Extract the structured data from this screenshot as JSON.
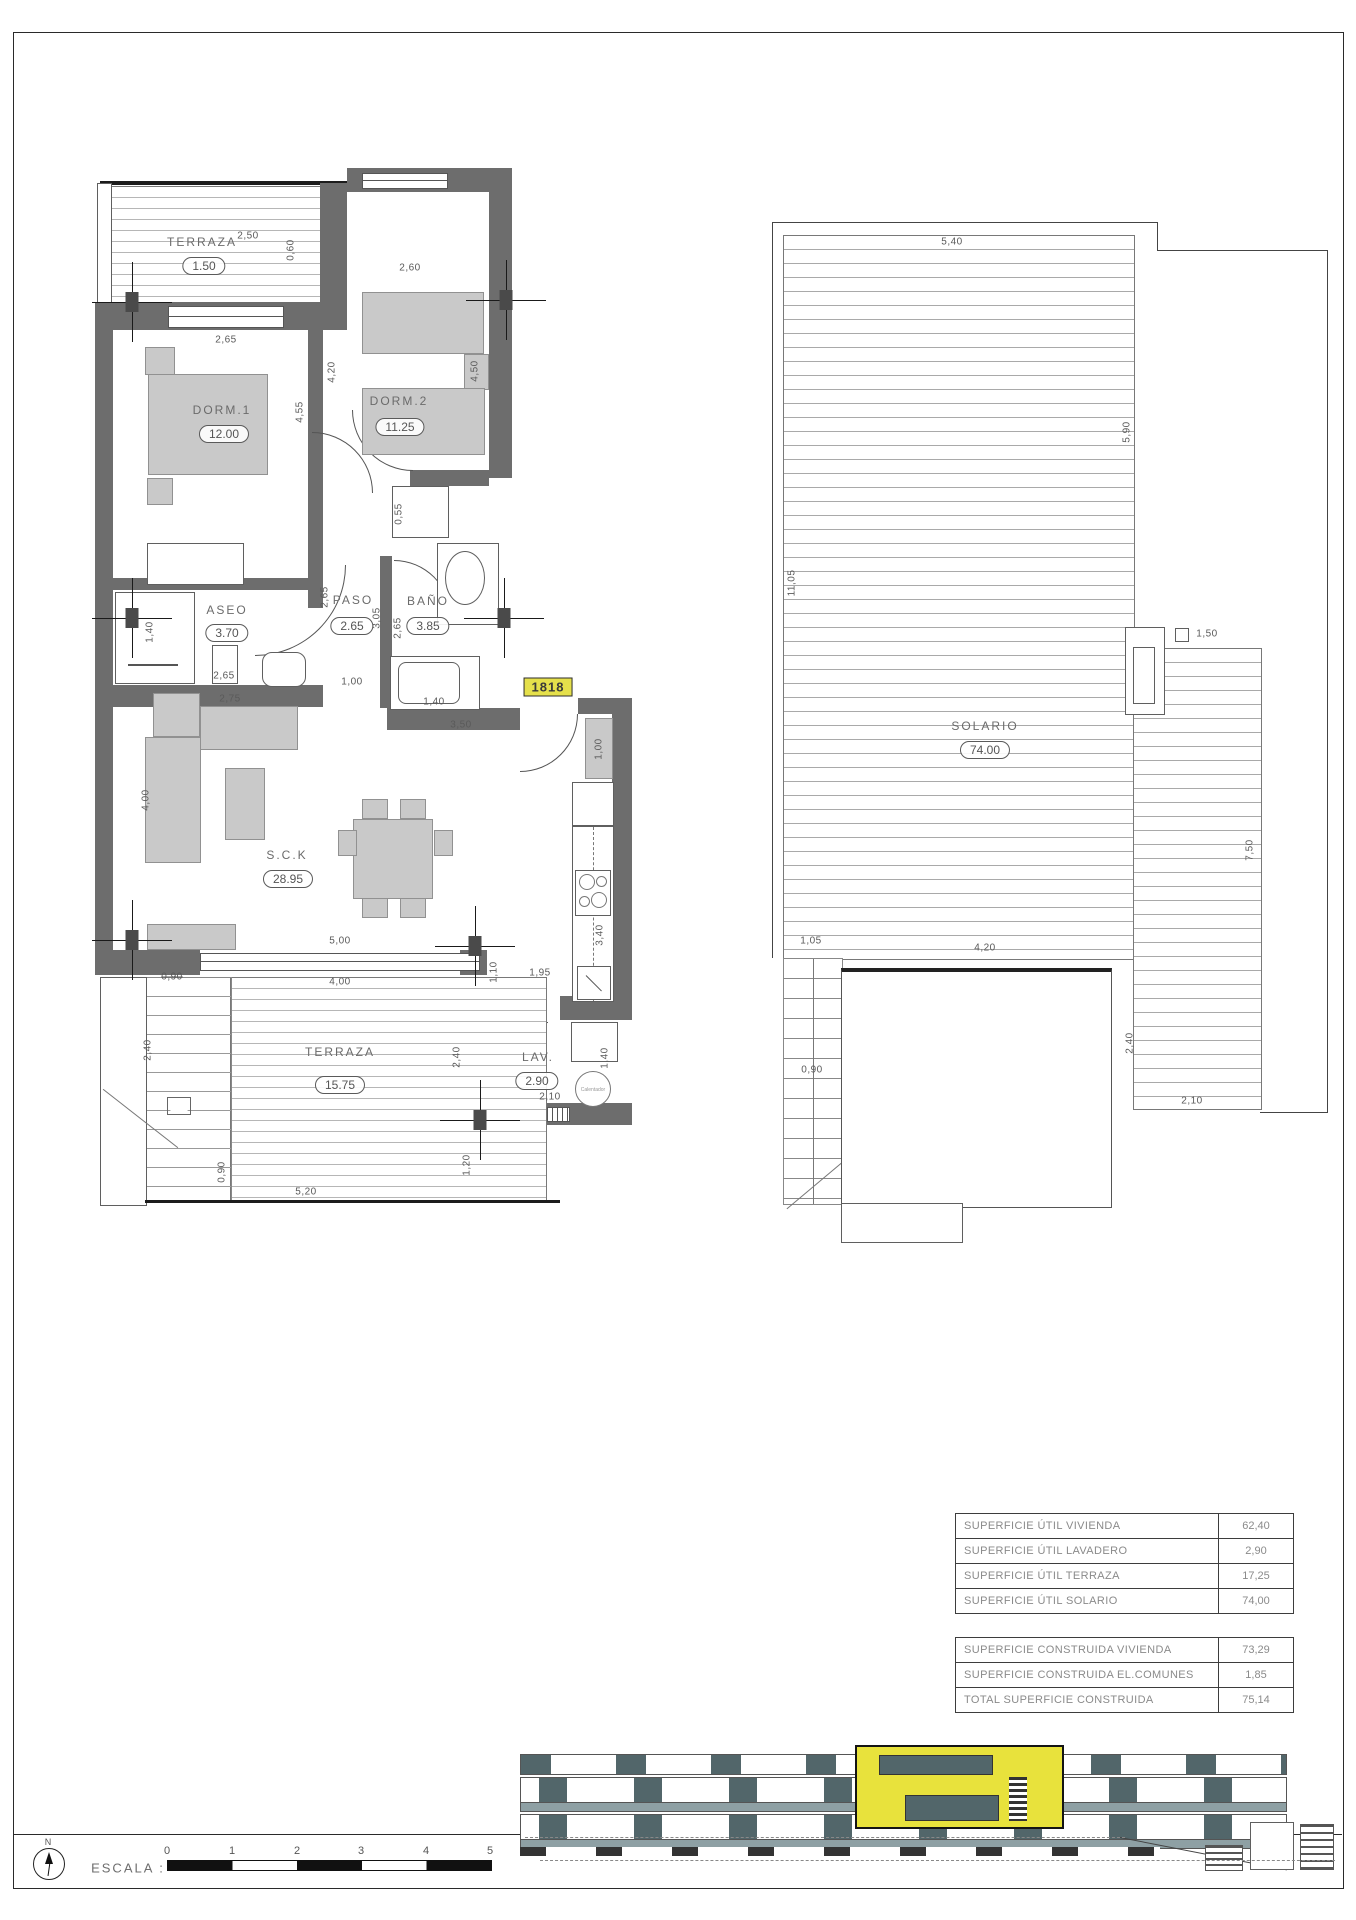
{
  "sheet": {
    "unit_badge": "1818",
    "compass_label": "N",
    "scale": {
      "label": "ESCALA :",
      "ticks": [
        "0",
        "1",
        "2",
        "3",
        "4",
        "5"
      ]
    }
  },
  "floor_plan": {
    "rooms": [
      {
        "name": "TERRAZA",
        "area": "1.50"
      },
      {
        "name": "DORM.1",
        "area": "12.00"
      },
      {
        "name": "DORM.2",
        "area": "11.25"
      },
      {
        "name": "ASEO",
        "area": "3.70"
      },
      {
        "name": "PASO",
        "area": "2.65"
      },
      {
        "name": "BAÑO",
        "area": "3.85"
      },
      {
        "name": "S.C.K",
        "area": "28.95"
      },
      {
        "name": "TERRAZA",
        "area": "15.75"
      },
      {
        "name": "LAV.",
        "area": "2.90"
      }
    ],
    "dims": [
      "2,50",
      "0,60",
      "2,65",
      "2,60",
      "4,20",
      "4,55",
      "4,50",
      "0,55",
      "1,40",
      "2,65",
      "2,65",
      "3,05",
      "2,65",
      "1,00",
      "2,75",
      "1,40",
      "3,50",
      "1,00",
      "3,40",
      "4,00",
      "5,00",
      "4,00",
      "0,90",
      "1,10",
      "1,95",
      "2,40",
      "2,40",
      "2,10",
      "1,40",
      "0,90",
      "5,20",
      "1,20"
    ],
    "heater_label": "Calentador"
  },
  "solarium_plan": {
    "room": {
      "name": "SOLARIO",
      "area": "74.00"
    },
    "dims": [
      "5,40",
      "5,90",
      "11,05",
      "1,50",
      "7,50",
      "1,05",
      "4,20",
      "0,90",
      "2,40",
      "2,10"
    ]
  },
  "surface_tables": {
    "util": {
      "rows": [
        {
          "label": "SUPERFICIE ÚTIL VIVIENDA",
          "value": "62,40"
        },
        {
          "label": "SUPERFICIE ÚTIL LAVADERO",
          "value": "2,90"
        },
        {
          "label": "SUPERFICIE ÚTIL TERRAZA",
          "value": "17,25"
        },
        {
          "label": "SUPERFICIE ÚTIL SOLARIO",
          "value": "74,00"
        }
      ]
    },
    "construida": {
      "rows": [
        {
          "label": "SUPERFICIE CONSTRUIDA VIVIENDA",
          "value": "73,29"
        },
        {
          "label": "SUPERFICIE CONSTRUIDA EL.COMUNES",
          "value": "1,85"
        },
        {
          "label": "TOTAL SUPERFICIE CONSTRUIDA",
          "value": "75,14"
        }
      ]
    }
  }
}
